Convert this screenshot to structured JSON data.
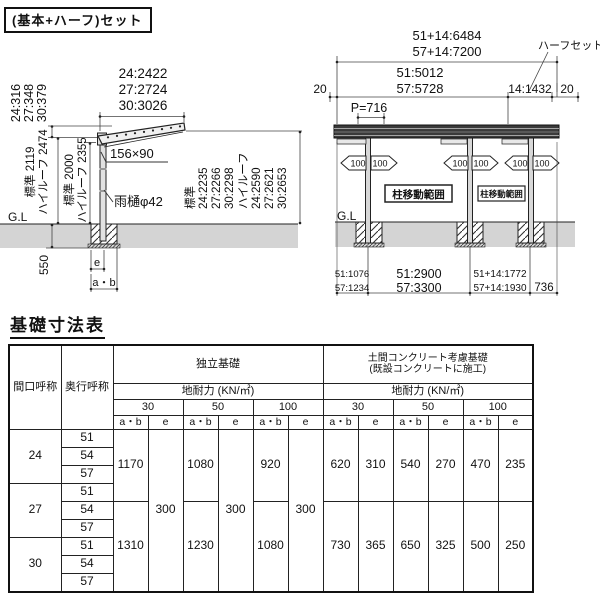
{
  "header": {
    "set_label": "(基本+ハーフ)セット"
  },
  "colors": {
    "ground": "#d4d4d4",
    "beam": "#3a3a3a",
    "line": "#1a1a1a"
  },
  "left_diagram": {
    "width_dims": [
      "24:2422",
      "27:2724",
      "30:3026"
    ],
    "rise_dims": [
      "24:316",
      "27:348",
      "30:379"
    ],
    "front_height_outer": [
      "標準 2119",
      "ハイルーフ 2474"
    ],
    "front_height_inner": [
      "標準 2000",
      "ハイルーフ 2355"
    ],
    "beam_size": "156×90",
    "gutter": "雨樋φ42",
    "gl": "G.L",
    "embed_depth": "550",
    "dim_e": "e",
    "dim_ab": "a・b",
    "rear_heights": [
      "標準",
      "24:2235",
      "27:2266",
      "30:2298",
      "ハイルーフ",
      "24:2590",
      "27:2621",
      "30:2653"
    ]
  },
  "right_diagram": {
    "total_dims": [
      "51+14:6484",
      "57+14:7200"
    ],
    "main_dims": [
      "51:5012",
      "57:5728"
    ],
    "half_dim": "14:1432",
    "edge_left": "20",
    "edge_right": "20",
    "half_set": "ハーフセット",
    "pitch": "P=716",
    "move_range_1": "柱移動範囲",
    "move_range_2": "柱移動範囲",
    "range_100": [
      "100",
      "100",
      "100",
      "100",
      "100",
      "100"
    ],
    "gl": "G.L",
    "span_dims_1": [
      "51:1076",
      "57:1234"
    ],
    "span_dims_2": [
      "51:2900",
      "57:3300"
    ],
    "span_dims_3": [
      "51+14:1772",
      "57+14:1930"
    ],
    "span_dims_4": "736"
  },
  "table": {
    "title": "基礎寸法表",
    "header": {
      "maguchi": "間口呼称",
      "okuyuki": "奥行呼称",
      "independent": "独立基礎",
      "doma_line1": "土間コンクリート考慮基礎",
      "doma_line2": "(既設コンクリートに施工)",
      "bearing1": "地耐力 (KN/㎡)",
      "bearing2": "地耐力 (KN/㎡)",
      "loads": [
        "30",
        "50",
        "100"
      ],
      "ab": "a・b",
      "e": "e"
    },
    "rows": {
      "maguchi": [
        "24",
        "27",
        "30"
      ],
      "okuyuki": [
        "51",
        "54",
        "57",
        "51",
        "54",
        "57",
        "51",
        "54",
        "57"
      ]
    },
    "indep": {
      "ab30": [
        "1170",
        "1310"
      ],
      "e30": "300",
      "ab50": [
        "1080",
        "1230"
      ],
      "e50": "300",
      "ab100": [
        "920",
        "1080"
      ],
      "e100": "300"
    },
    "doma": {
      "ab30": [
        "620",
        "730"
      ],
      "e30": [
        "310",
        "365"
      ],
      "ab50": [
        "540",
        "650"
      ],
      "e50": [
        "270",
        "325"
      ],
      "ab100": [
        "470",
        "500"
      ],
      "e100": [
        "235",
        "250"
      ]
    }
  }
}
